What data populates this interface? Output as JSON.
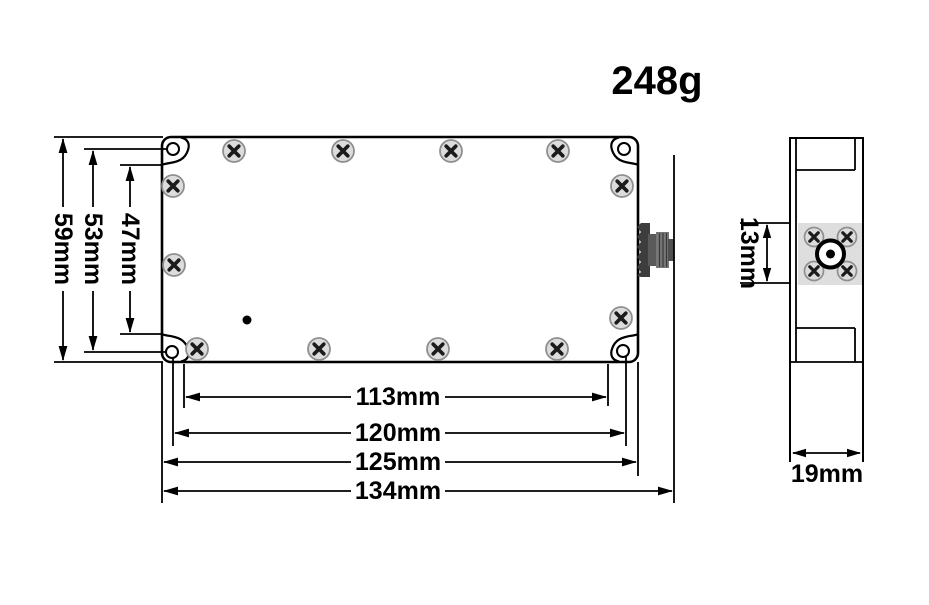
{
  "weight_label": "248g",
  "front_view": {
    "height_dimensions": {
      "overall": "59mm",
      "hole_to_hole": "53mm",
      "inner": "47mm"
    },
    "width_dimensions": {
      "inner": "113mm",
      "hole_to_hole": "120mm",
      "body": "125mm",
      "overall_with_connector": "134mm"
    }
  },
  "side_view": {
    "connector_flange_height": "13mm",
    "depth": "19mm"
  },
  "colors": {
    "line": "#000000",
    "screw_fill": "#dcdcdc",
    "screw_rim": "#8f8f8f",
    "flange_fill": "#dedede",
    "connector_dark": "#3d3d3d"
  }
}
